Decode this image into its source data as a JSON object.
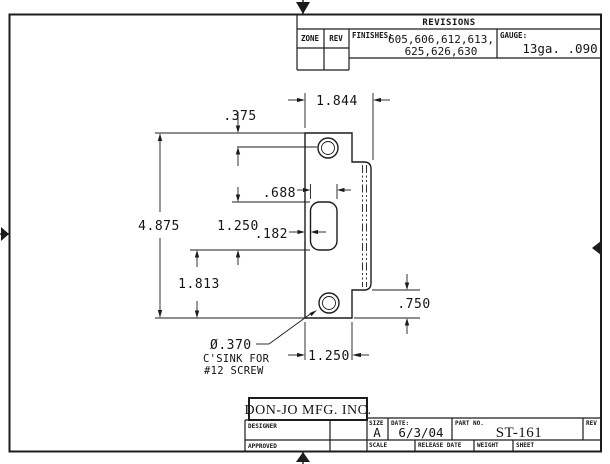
{
  "revisions": {
    "title": "REVISIONS",
    "zone_label": "ZONE",
    "rev_label": "REV",
    "finishes_label": "FINISHES:",
    "finishes_line1": "605,606,612,613,",
    "finishes_line2": "625,626,630",
    "gauge_label": "GAUGE:",
    "gauge_value": "13ga.  .090"
  },
  "title_block": {
    "company": "DON-JO MFG. INC.",
    "designer_label": "DESIGNER",
    "approved_label": "APPROVED",
    "size_label": "SIZE",
    "size_value": "A",
    "date_label": "DATE:",
    "date_value": "6/3/04",
    "part_label": "PART NO.",
    "part_value": "ST-161",
    "rev_label": "REV",
    "scale_label": "SCALE",
    "release_date_label": "RELEASE DATE",
    "weight_label": "WEIGHT",
    "sheet_label": "SHEET"
  },
  "dims": {
    "top_hole_offset": ".375",
    "overall_width": "1.844",
    "opening_width": ".688",
    "overall_height": "4.875",
    "opening_height": "1.250",
    "opening_offset": ".182",
    "bottom_section": "1.813",
    "lip_tab_height": ".750",
    "flat_width": "1.250",
    "hole_diameter": "Ø.370",
    "csink_line1": "C'SINK FOR",
    "csink_line2": "#12 SCREW"
  }
}
